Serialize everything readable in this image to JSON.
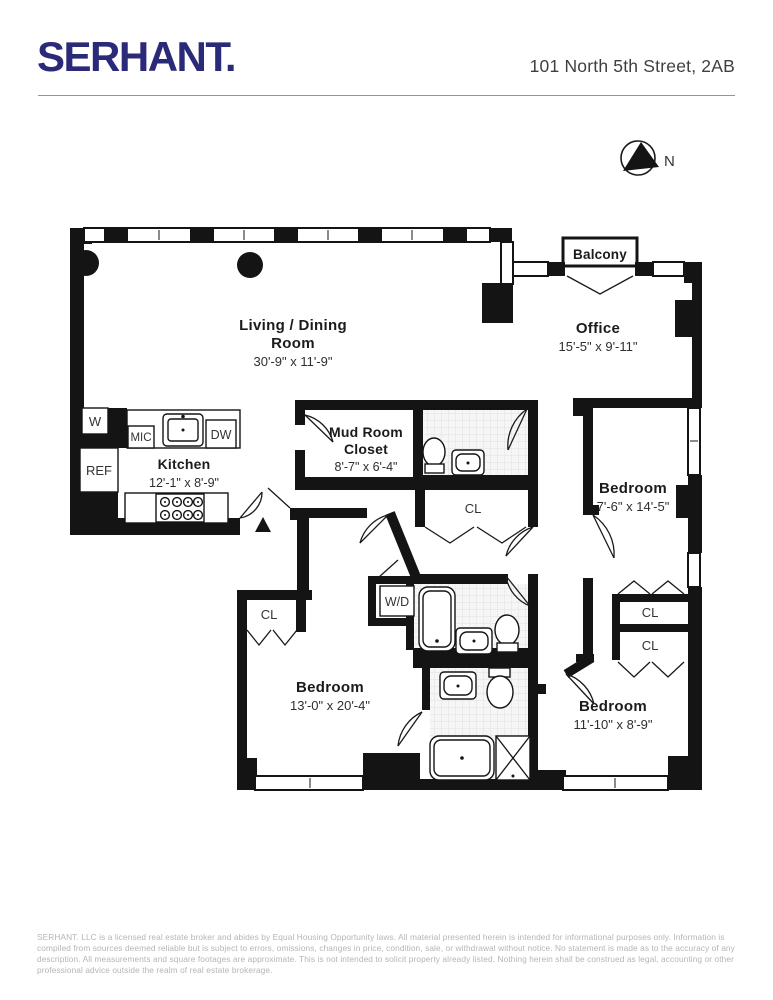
{
  "header": {
    "logo": "SERHANT.",
    "address": "101 North 5th Street, 2AB"
  },
  "compass": {
    "north_label": "N"
  },
  "rooms": {
    "living": {
      "name_line1": "Living / Dining",
      "name_line2": "Room",
      "dims": "30'-9\" x 11'-9\""
    },
    "office": {
      "name": "Office",
      "dims": "15'-5\" x 9'-11\""
    },
    "balcony": {
      "name": "Balcony"
    },
    "kitchen": {
      "name": "Kitchen",
      "dims": "12'-1\" x 8'-9\""
    },
    "mudroom": {
      "name_line1": "Mud Room",
      "name_line2": "Closet",
      "dims": "8'-7\" x 6'-4\""
    },
    "bedroom_east": {
      "name": "Bedroom",
      "dims": "7'-6\" x 14'-5\""
    },
    "bedroom_southwest": {
      "name": "Bedroom",
      "dims": "13'-0\" x 20'-4\""
    },
    "bedroom_southeast": {
      "name": "Bedroom",
      "dims": "11'-10\" x 8'-9\""
    }
  },
  "fixtures": {
    "washer": "W",
    "refrigerator": "REF",
    "microwave": "MIC",
    "dishwasher": "DW",
    "washer_dryer": "W/D",
    "closet": "CL"
  },
  "colors": {
    "brand_navy": "#2b2a78",
    "wall_black": "#141414",
    "footer_gray": "#b5b5b5"
  },
  "footer": {
    "disclaimer": "SERHANT. LLC is a licensed real estate broker and abides by Equal Housing Opportunity laws. All material presented herein is intended for informational purposes only. Information is compiled from sources deemed reliable but is subject to errors, omissions, changes in price, condition, sale, or withdrawal without notice. No statement is made as to the accuracy of any description. All measurements and square footages are approximate. This is not intended to solicit property already listed. Nothing herein shall be construed as legal, accounting or other professional advice outside the realm of real estate brokerage."
  }
}
